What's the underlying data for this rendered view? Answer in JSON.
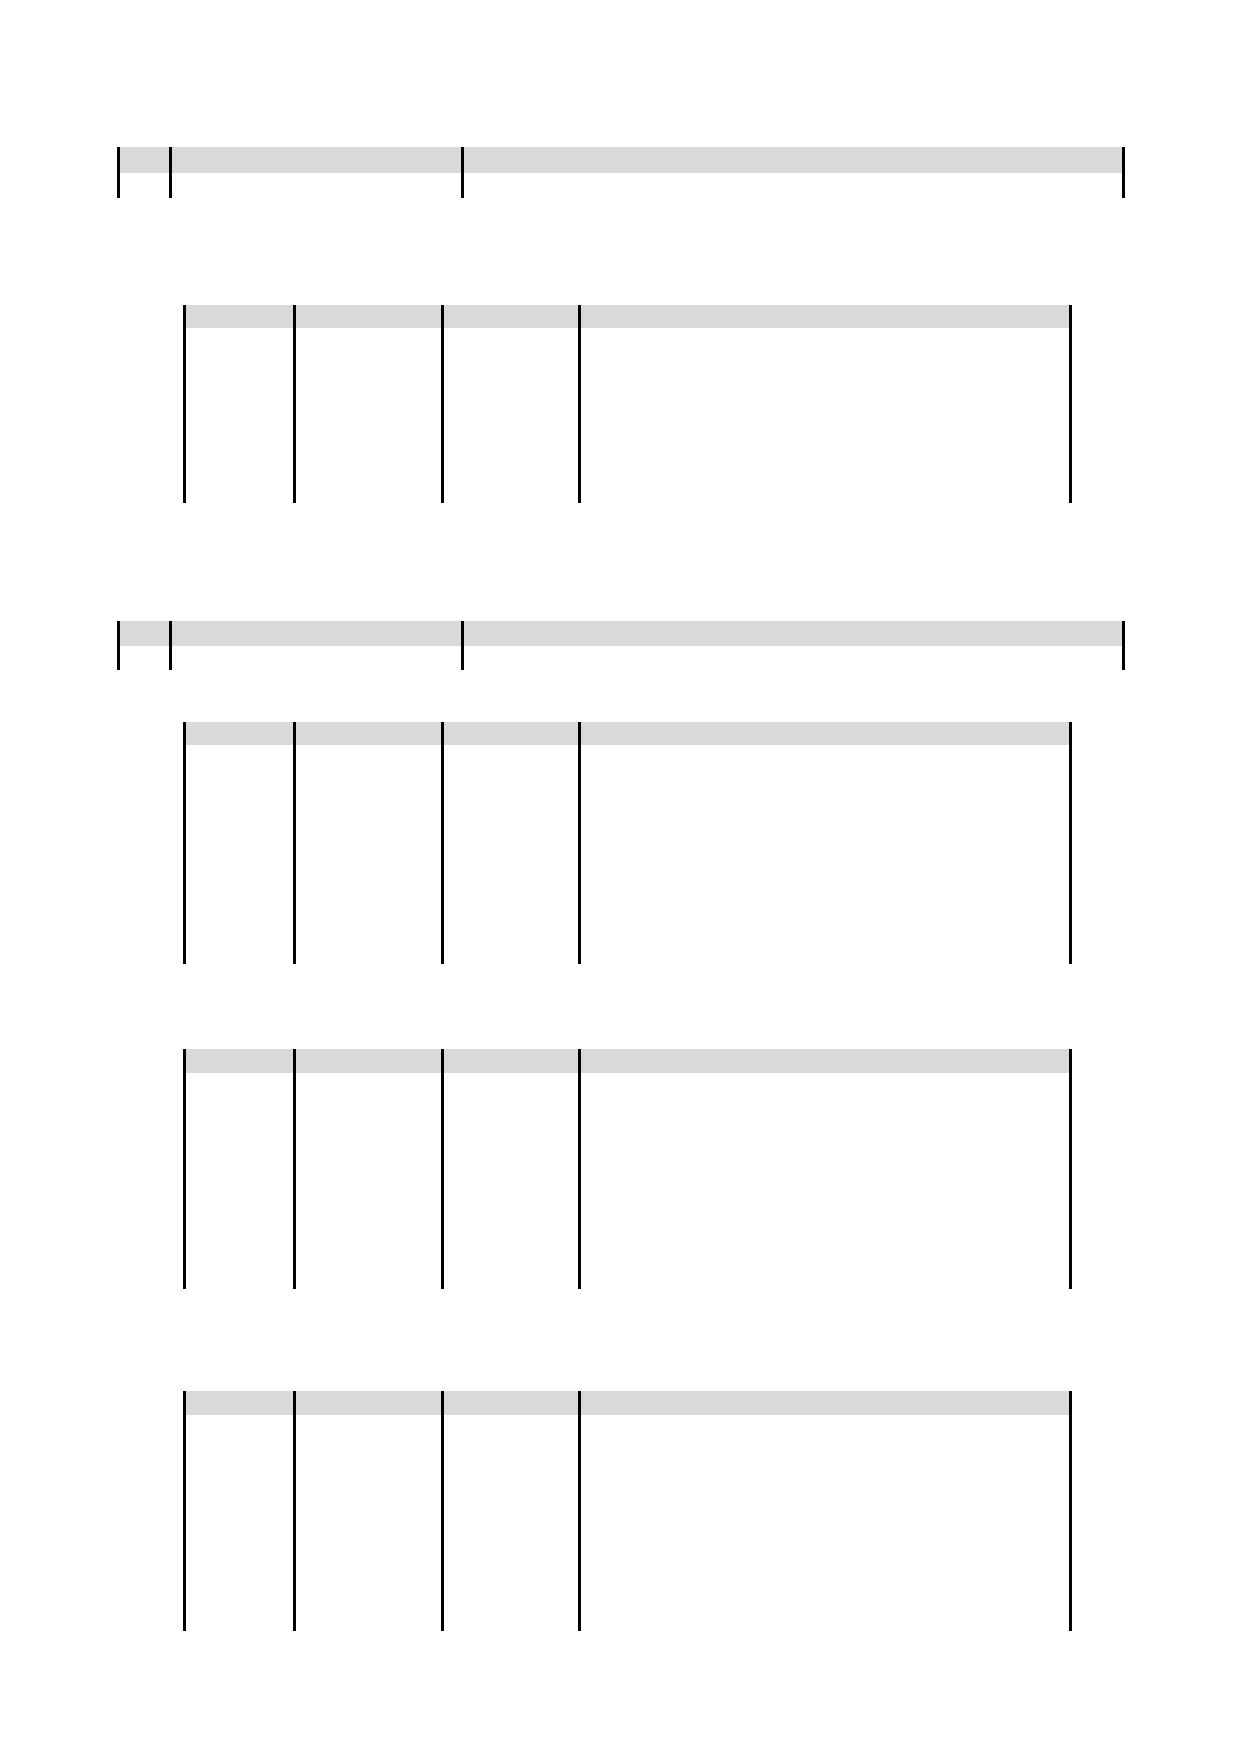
{
  "page": {
    "width": 1240,
    "height": 1754,
    "background": "#ffffff"
  },
  "styles": {
    "header_fill": "#d9d9d9",
    "border_color": "#000000",
    "border_width": 3
  },
  "tables": [
    {
      "name": "record-header-table-1",
      "kind": "header-row",
      "top": 147,
      "header_bottom": 173,
      "bottom": 198,
      "column_lines": [
        117,
        169,
        461,
        1122
      ],
      "header_cells": [
        "",
        "",
        ""
      ]
    },
    {
      "name": "detail-table-1",
      "kind": "detail",
      "top": 305,
      "header_bottom": 328,
      "bottom": 503,
      "column_lines": [
        183,
        293,
        441,
        578,
        1069
      ],
      "header_cells": [
        "",
        "",
        "",
        ""
      ]
    },
    {
      "name": "record-header-table-2",
      "kind": "header-row",
      "top": 621,
      "header_bottom": 646,
      "bottom": 670,
      "column_lines": [
        117,
        169,
        461,
        1122
      ],
      "header_cells": [
        "",
        "",
        ""
      ]
    },
    {
      "name": "detail-table-2",
      "kind": "detail",
      "top": 722,
      "header_bottom": 745,
      "bottom": 964,
      "column_lines": [
        183,
        293,
        441,
        578,
        1069
      ],
      "header_cells": [
        "",
        "",
        "",
        ""
      ]
    },
    {
      "name": "detail-table-3",
      "kind": "detail",
      "top": 1049,
      "header_bottom": 1073,
      "bottom": 1289,
      "column_lines": [
        183,
        293,
        441,
        578,
        1069
      ],
      "header_cells": [
        "",
        "",
        "",
        ""
      ]
    },
    {
      "name": "detail-table-4",
      "kind": "detail",
      "top": 1391,
      "header_bottom": 1415,
      "bottom": 1631,
      "column_lines": [
        183,
        293,
        441,
        578,
        1069
      ],
      "header_cells": [
        "",
        "",
        "",
        ""
      ]
    }
  ]
}
